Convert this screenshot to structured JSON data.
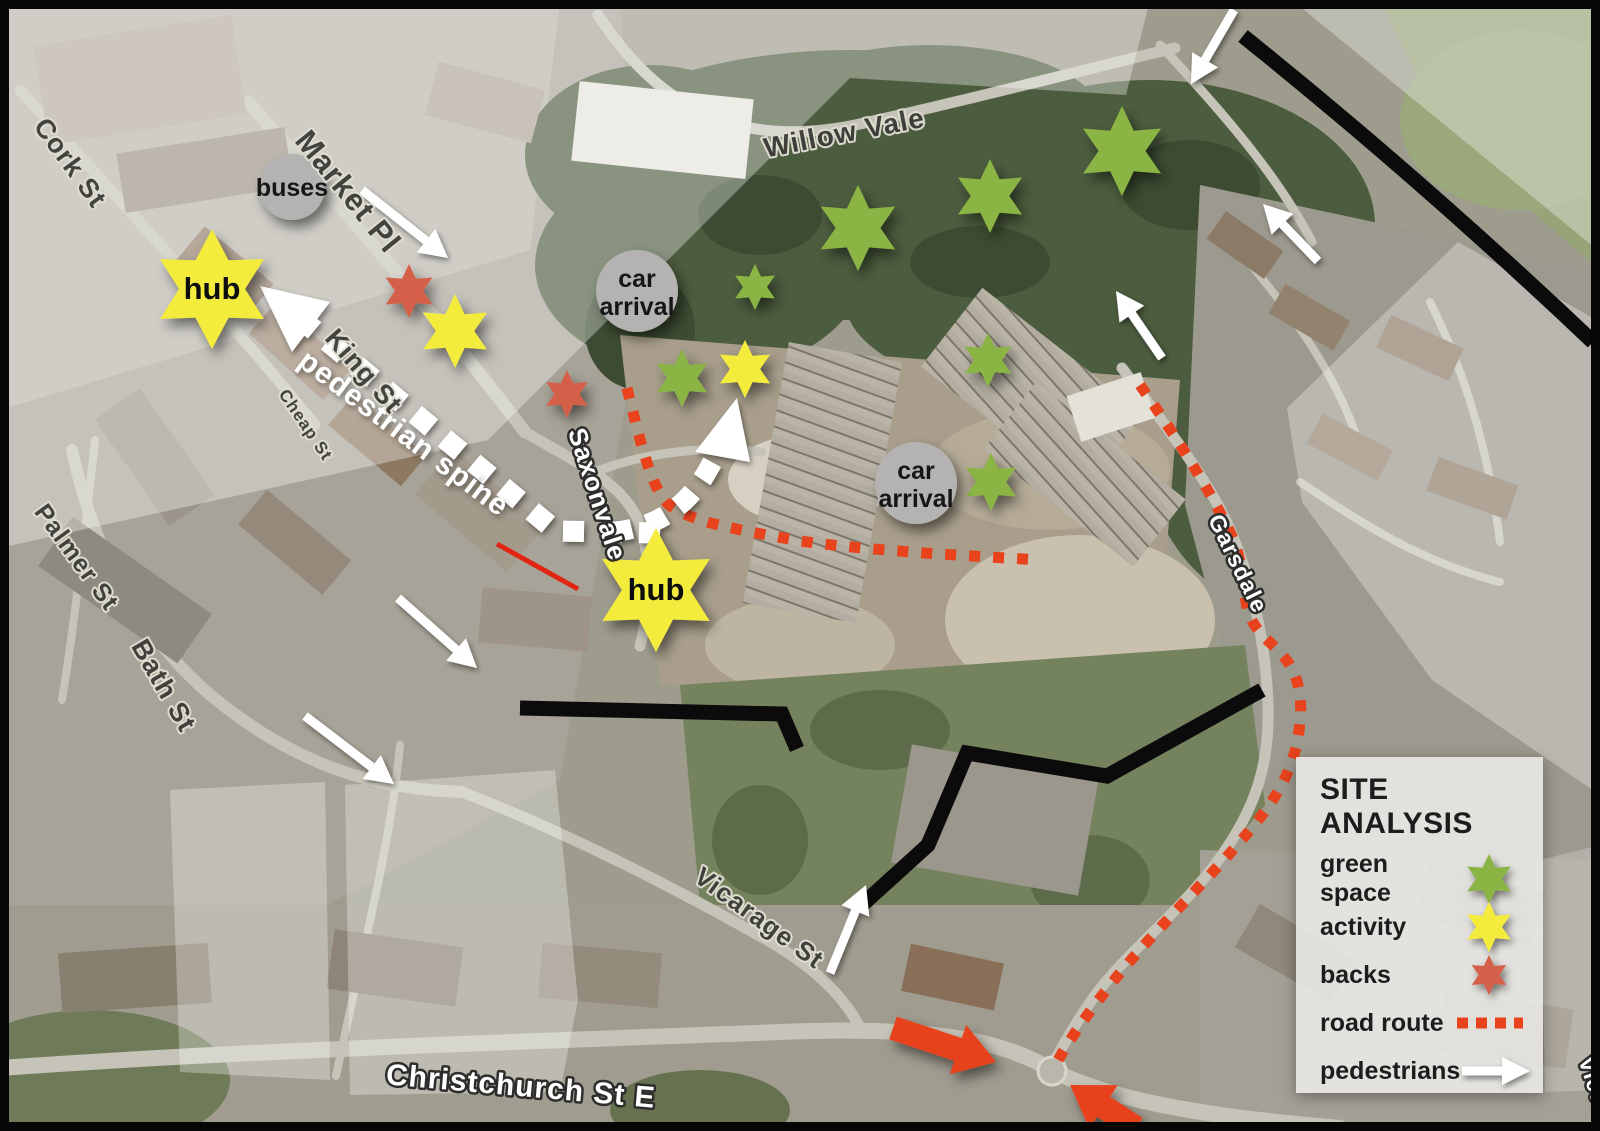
{
  "legend": {
    "title": "SITE ANALYSIS",
    "items": [
      {
        "label": "green space",
        "marker": "star",
        "color": "#8ab545",
        "size": 25
      },
      {
        "label": "activity",
        "marker": "star",
        "color": "#f4ec3c",
        "size": 25
      },
      {
        "label": "backs",
        "marker": "star",
        "color": "#d5604a",
        "size": 20
      },
      {
        "label": "road route",
        "marker": "dashes",
        "color": "#e8431d",
        "size": 0
      },
      {
        "label": "pedestrians",
        "marker": "arrow",
        "color": "#ffffff",
        "size": 0
      }
    ]
  },
  "colors": {
    "green_star": "#8ab545",
    "yellow_star": "#f4ec3c",
    "red_star": "#d5604a",
    "road_route": "#e8431d",
    "pedestrian_white": "#ffffff",
    "black_line": "#0b0b0b",
    "grey_circle": "#b4b3b1"
  },
  "street_labels": [
    {
      "text": "Cork St",
      "x": 63,
      "y": 168,
      "rotate": 54,
      "size": 27,
      "style": "dark"
    },
    {
      "text": "Market Pl",
      "x": 340,
      "y": 198,
      "rotate": 51,
      "size": 31,
      "style": "dark"
    },
    {
      "text": "King St",
      "x": 357,
      "y": 377,
      "rotate": 49,
      "size": 27,
      "style": "dark"
    },
    {
      "text": "Cheap St",
      "x": 301,
      "y": 428,
      "rotate": 56,
      "size": 17,
      "style": "dark"
    },
    {
      "text": "Palmer St",
      "x": 70,
      "y": 562,
      "rotate": 54,
      "size": 25,
      "style": "dark"
    },
    {
      "text": "Bath St",
      "x": 156,
      "y": 690,
      "rotate": 60,
      "size": 27,
      "style": "dark"
    },
    {
      "text": "Willow Vale",
      "x": 846,
      "y": 142,
      "rotate": -11,
      "size": 28,
      "style": "dark"
    },
    {
      "text": "Saxonvale",
      "x": 589,
      "y": 497,
      "rotate": 72,
      "size": 26,
      "style": "light"
    },
    {
      "text": "Garsdale",
      "x": 1231,
      "y": 567,
      "rotate": 64,
      "size": 23,
      "style": "light"
    },
    {
      "text": "Vicarage St",
      "x": 754,
      "y": 925,
      "rotate": 36,
      "size": 26,
      "style": "dark"
    },
    {
      "text": "Christchurch St E",
      "x": 520,
      "y": 1096,
      "rotate": 5,
      "size": 30,
      "style": "light"
    },
    {
      "text": "Victoria",
      "x": 1592,
      "y": 1102,
      "rotate": 72,
      "size": 22,
      "style": "light"
    }
  ],
  "spine_label": {
    "text": "pedestrian spine",
    "x": 398,
    "y": 441,
    "rotate": 37,
    "size": 30
  },
  "circles": [
    {
      "lines": [
        "buses"
      ],
      "x": 292,
      "y": 187,
      "r": 33
    },
    {
      "lines": [
        "car",
        "arrival"
      ],
      "x": 637,
      "y": 291,
      "r": 41
    },
    {
      "lines": [
        "car",
        "arrival"
      ],
      "x": 916,
      "y": 483,
      "r": 41
    }
  ],
  "hub_stars": [
    {
      "label": "hub",
      "x": 212,
      "y": 289,
      "r": 60
    },
    {
      "label": "hub",
      "x": 656,
      "y": 590,
      "r": 62
    }
  ],
  "stars": {
    "green": {
      "points": [
        [
          755,
          287,
          23
        ],
        [
          858,
          228,
          43
        ],
        [
          990,
          196,
          37
        ],
        [
          1122,
          151,
          45
        ],
        [
          682,
          378,
          29
        ],
        [
          988,
          360,
          27
        ],
        [
          991,
          482,
          29
        ]
      ]
    },
    "yellow": {
      "points": [
        [
          455,
          331,
          37
        ],
        [
          745,
          369,
          29
        ]
      ]
    },
    "red": {
      "points": [
        [
          409,
          291,
          27
        ],
        [
          567,
          394,
          24
        ]
      ]
    }
  },
  "pedestrian_arrows": [
    [
      362,
      190,
      448,
      258
    ],
    [
      1234,
      10,
      1191,
      84
    ],
    [
      1318,
      261,
      1263,
      204
    ],
    [
      1162,
      358,
      1116,
      291
    ],
    [
      398,
      598,
      477,
      668
    ],
    [
      305,
      716,
      394,
      784
    ],
    [
      830,
      973,
      866,
      885
    ]
  ],
  "vehicle_arrows": [
    [
      893,
      1028,
      996,
      1062
    ],
    [
      1136,
      1128,
      1070,
      1085
    ]
  ]
}
